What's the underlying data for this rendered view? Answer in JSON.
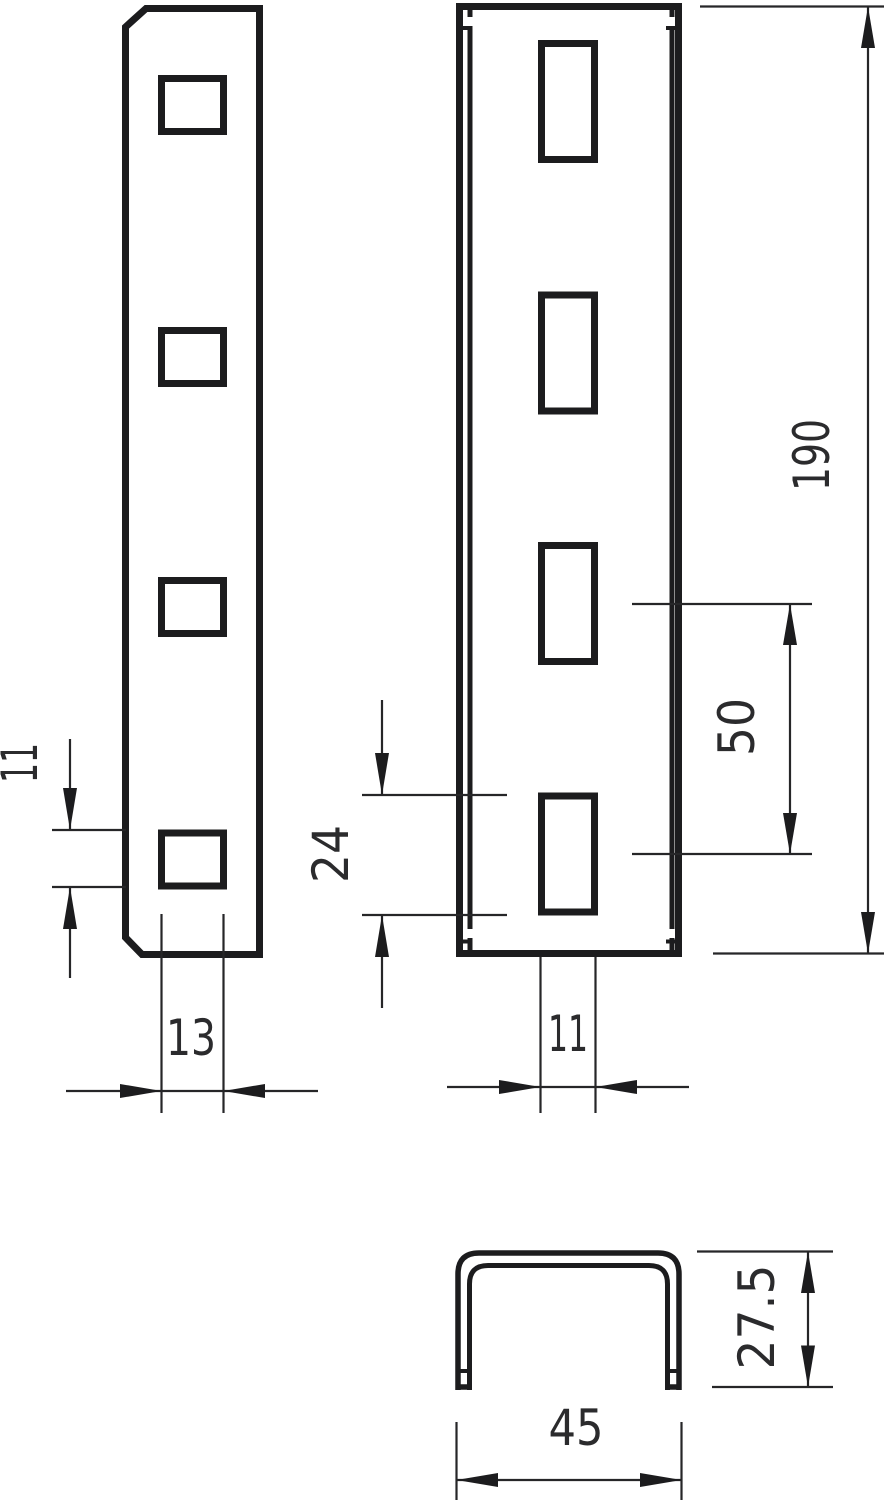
{
  "colors": {
    "line": "#1c1c1e",
    "text": "#2b2b2d",
    "background": "#ffffff"
  },
  "dimensions": {
    "side_hole_height": "11",
    "side_hole_width": "13",
    "total_length": "190",
    "slot_spacing": "50",
    "slot_length": "24",
    "slot_width": "11",
    "profile_height": "27.5",
    "profile_width": "45"
  }
}
